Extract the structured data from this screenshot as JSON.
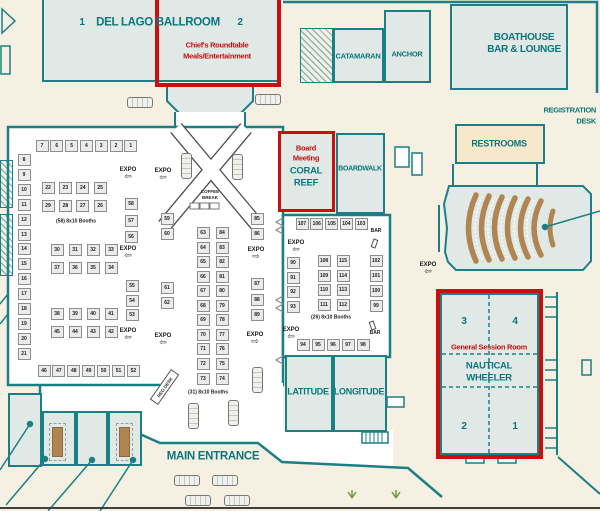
{
  "colors": {
    "wall_teal": "#1b7f86",
    "text_teal": "#0a767d",
    "annotation_red": "#c9100f",
    "background_cream": "#f6f0e2",
    "room_fill": "#e1e9e6",
    "restroom_tan": "#f6e8ca",
    "seating_brown": "#b08551",
    "booth_fill": "#eaecea"
  },
  "labels": {
    "del_lago": "DEL LAGO BALLROOM",
    "del_lago_section_1": "1",
    "del_lago_section_2": "2",
    "chiefs_roundtable_line1": "Chief's Roundtable",
    "chiefs_roundtable_line2": "Meals/Entertainment",
    "catamaran": "CATAMARAN",
    "anchor": "ANCHOR",
    "boathouse_line1": "BOATHOUSE",
    "boathouse_line2": "BAR & LOUNGE",
    "registration_line1": "REGISTRATION",
    "registration_line2": "DESK",
    "restrooms": "RESTROOMS",
    "board_meeting_line1": "Board",
    "board_meeting_line2": "Meeting",
    "coral_reef_line1": "CORAL",
    "coral_reef_line2": "REEF",
    "boardwalk": "BOARDWALK",
    "general_session_room": "General Session Room",
    "nautical_line1": "NAUTICAL",
    "nautical_line2": "WHEELER",
    "nautical_section_1": "1",
    "nautical_section_2": "2",
    "nautical_section_3": "3",
    "nautical_section_4": "4",
    "latitude": "LATITUDE",
    "longitude": "LONGITUDE",
    "main_entrance": "MAIN ENTRANCE",
    "reg_desk": "REG DESK",
    "coffee_break_line1": "COFFEE",
    "coffee_break_line2": "BREAK",
    "left_booth_caption": "(58) 8x10 Booths",
    "center_booth_caption": "(31) 8x10 Booths",
    "right_booth_caption": "(26) 8x10 Booths",
    "expo": "EXPO",
    "bar": "BAR"
  },
  "booth_groups": [
    {
      "x": 42,
      "y": 146,
      "dx": 14.8,
      "dy": 0,
      "nums": [
        7,
        6,
        5,
        4,
        3,
        2,
        1
      ]
    },
    {
      "x": 24,
      "y": 160,
      "dx": 0,
      "dy": 14.9,
      "nums": [
        8,
        9,
        10,
        11,
        12,
        13,
        14,
        15,
        16,
        17,
        18,
        19,
        20,
        21
      ]
    },
    {
      "x": 48,
      "y": 188,
      "dx": 17.4,
      "dy": 0,
      "nums": [
        22,
        23,
        24,
        25
      ]
    },
    {
      "x": 48,
      "y": 206,
      "dx": 17.4,
      "dy": 0,
      "nums": [
        29,
        28,
        27,
        26
      ]
    },
    {
      "x": 57,
      "y": 250,
      "dx": 18,
      "dy": 0,
      "nums": [
        30,
        31,
        32,
        33
      ]
    },
    {
      "x": 57,
      "y": 268,
      "dx": 18,
      "dy": 0,
      "nums": [
        37,
        36,
        35,
        34
      ]
    },
    {
      "x": 57,
      "y": 314,
      "dx": 18,
      "dy": 0,
      "nums": [
        38,
        39,
        40,
        41
      ]
    },
    {
      "x": 57,
      "y": 332,
      "dx": 18,
      "dy": 0,
      "nums": [
        45,
        44,
        43,
        42
      ]
    },
    {
      "x": 44,
      "y": 371,
      "dx": 14.9,
      "dy": 0,
      "nums": [
        46,
        47,
        48,
        49,
        50,
        51,
        52
      ]
    },
    {
      "x": 131,
      "y": 204,
      "dx": 0,
      "dy": 16.5,
      "nums": [
        58,
        57,
        56
      ]
    },
    {
      "x": 132,
      "y": 286,
      "dx": 0,
      "dy": 14.5,
      "nums": [
        55,
        54,
        53
      ]
    },
    {
      "x": 167,
      "y": 219,
      "dx": 0,
      "dy": 14.6,
      "nums": [
        59,
        60
      ]
    },
    {
      "x": 167,
      "y": 288,
      "dx": 0,
      "dy": 15,
      "nums": [
        61,
        62
      ]
    },
    {
      "x": 203,
      "y": 233,
      "dx": 0,
      "dy": 14.55,
      "nums": [
        63,
        64,
        65,
        66,
        67,
        68,
        69,
        70,
        71,
        72,
        73
      ]
    },
    {
      "x": 222,
      "y": 233,
      "dx": 0,
      "dy": 14.55,
      "nums": [
        84,
        83,
        82,
        81,
        80,
        79,
        78,
        77,
        76,
        75,
        74
      ]
    },
    {
      "x": 257,
      "y": 219,
      "dx": 0,
      "dy": 14.6,
      "nums": [
        85,
        86
      ]
    },
    {
      "x": 257,
      "y": 284,
      "dx": 0,
      "dy": 15.5,
      "nums": [
        87,
        88,
        89
      ]
    },
    {
      "x": 302,
      "y": 224,
      "dx": 14.8,
      "dy": 0,
      "nums": [
        107,
        106,
        105,
        104,
        103
      ]
    },
    {
      "x": 324,
      "y": 261,
      "dx": 0,
      "dy": 14.7,
      "nums": [
        108,
        109,
        110,
        111
      ]
    },
    {
      "x": 343,
      "y": 261,
      "dx": 0,
      "dy": 14.7,
      "nums": [
        115,
        114,
        113,
        112
      ]
    },
    {
      "x": 376,
      "y": 261,
      "dx": 0,
      "dy": 14.9,
      "nums": [
        102,
        101,
        100,
        99
      ]
    },
    {
      "x": 293,
      "y": 263,
      "dx": 0,
      "dy": 14.7,
      "nums": [
        90,
        91,
        92,
        93
      ]
    },
    {
      "x": 303,
      "y": 345,
      "dx": 15,
      "dy": 0,
      "nums": [
        94,
        95,
        96,
        97,
        98
      ]
    }
  ],
  "expo_markers": [
    {
      "x": 128,
      "y": 167,
      "dir": "left"
    },
    {
      "x": 128,
      "y": 246,
      "dir": "left"
    },
    {
      "x": 128,
      "y": 328,
      "dir": "left"
    },
    {
      "x": 163,
      "y": 168,
      "dir": "left"
    },
    {
      "x": 163,
      "y": 333,
      "dir": "left"
    },
    {
      "x": 256,
      "y": 247,
      "dir": "right"
    },
    {
      "x": 255,
      "y": 332,
      "dir": "right"
    },
    {
      "x": 296,
      "y": 240,
      "dir": "left"
    },
    {
      "x": 291,
      "y": 327,
      "dir": "left"
    },
    {
      "x": 428,
      "y": 262,
      "dir": "left"
    }
  ],
  "bar_markers": [
    {
      "x": 376,
      "y": 231,
      "icon_x": 372,
      "icon_y": 239,
      "rot": 20
    },
    {
      "x": 375,
      "y": 333,
      "icon_x": 370,
      "icon_y": 321,
      "rot": -20
    }
  ],
  "trucks": [
    {
      "x": 140,
      "y": 102,
      "o": "h"
    },
    {
      "x": 268,
      "y": 99,
      "o": "h"
    },
    {
      "x": 186,
      "y": 166,
      "o": "v"
    },
    {
      "x": 237,
      "y": 167,
      "o": "v"
    },
    {
      "x": 257,
      "y": 380,
      "o": "v"
    },
    {
      "x": 193,
      "y": 416,
      "o": "v"
    },
    {
      "x": 233,
      "y": 413,
      "o": "v"
    },
    {
      "x": 187,
      "y": 480,
      "o": "h"
    },
    {
      "x": 225,
      "y": 480,
      "o": "h"
    },
    {
      "x": 198,
      "y": 500,
      "o": "h"
    },
    {
      "x": 237,
      "y": 500,
      "o": "h"
    }
  ]
}
